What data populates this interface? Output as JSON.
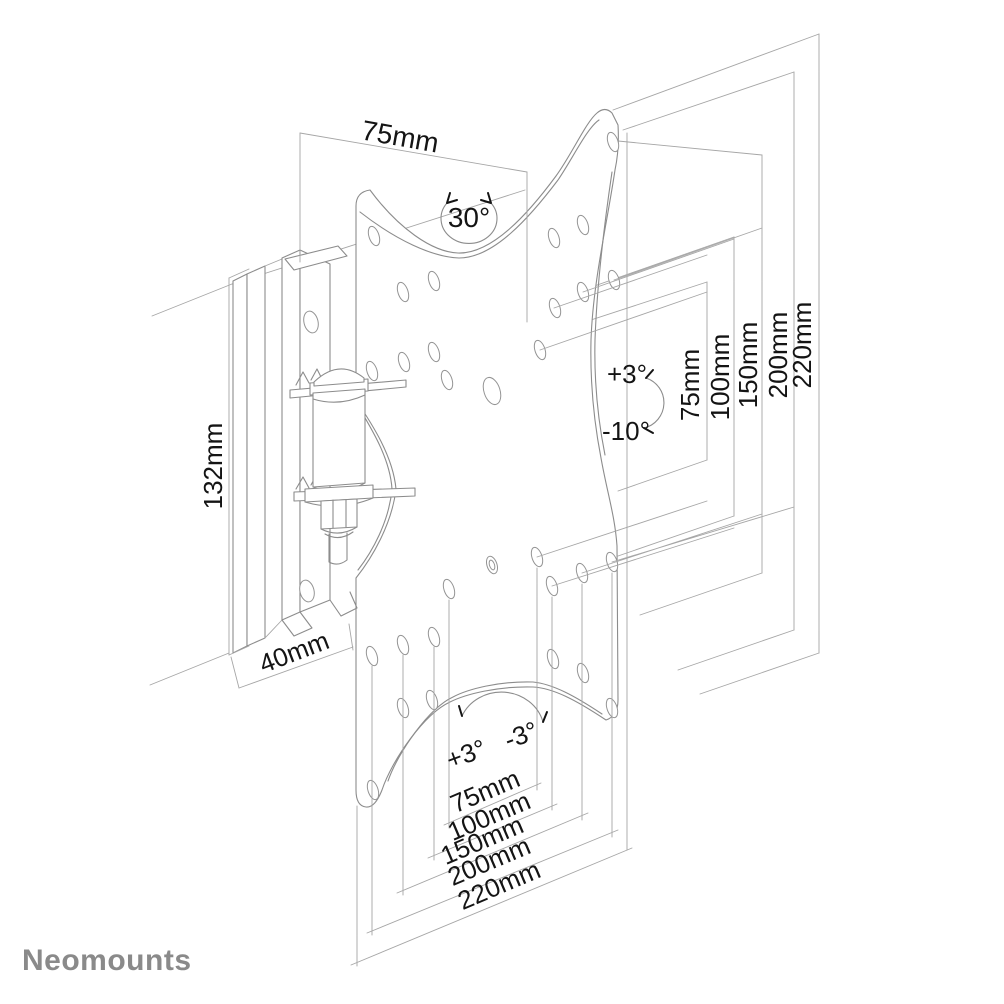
{
  "drawing": {
    "title_semantic": "TV wall mount technical line drawing",
    "dim_top_width": "75mm",
    "swivel_range": "30°",
    "dim_arm_height": "132mm",
    "dim_arm_depth": "40mm",
    "tilt_up": "+3°",
    "tilt_down": "-10°",
    "swivel_left": "+3°",
    "swivel_right": "-3°",
    "vesa_widths_vertical": [
      "75mm",
      "100mm",
      "150mm",
      "200mm",
      "220mm"
    ],
    "vesa_widths_bottom": [
      "75mm",
      "100mm",
      "150mm",
      "200mm",
      "220mm"
    ]
  },
  "brand": {
    "logo_text": "Neomounts",
    "logo_color": "#8a8a8a"
  },
  "canvas": {
    "background": "#ffffff",
    "line_color": "#8c8c8c",
    "text_color": "#141414"
  }
}
